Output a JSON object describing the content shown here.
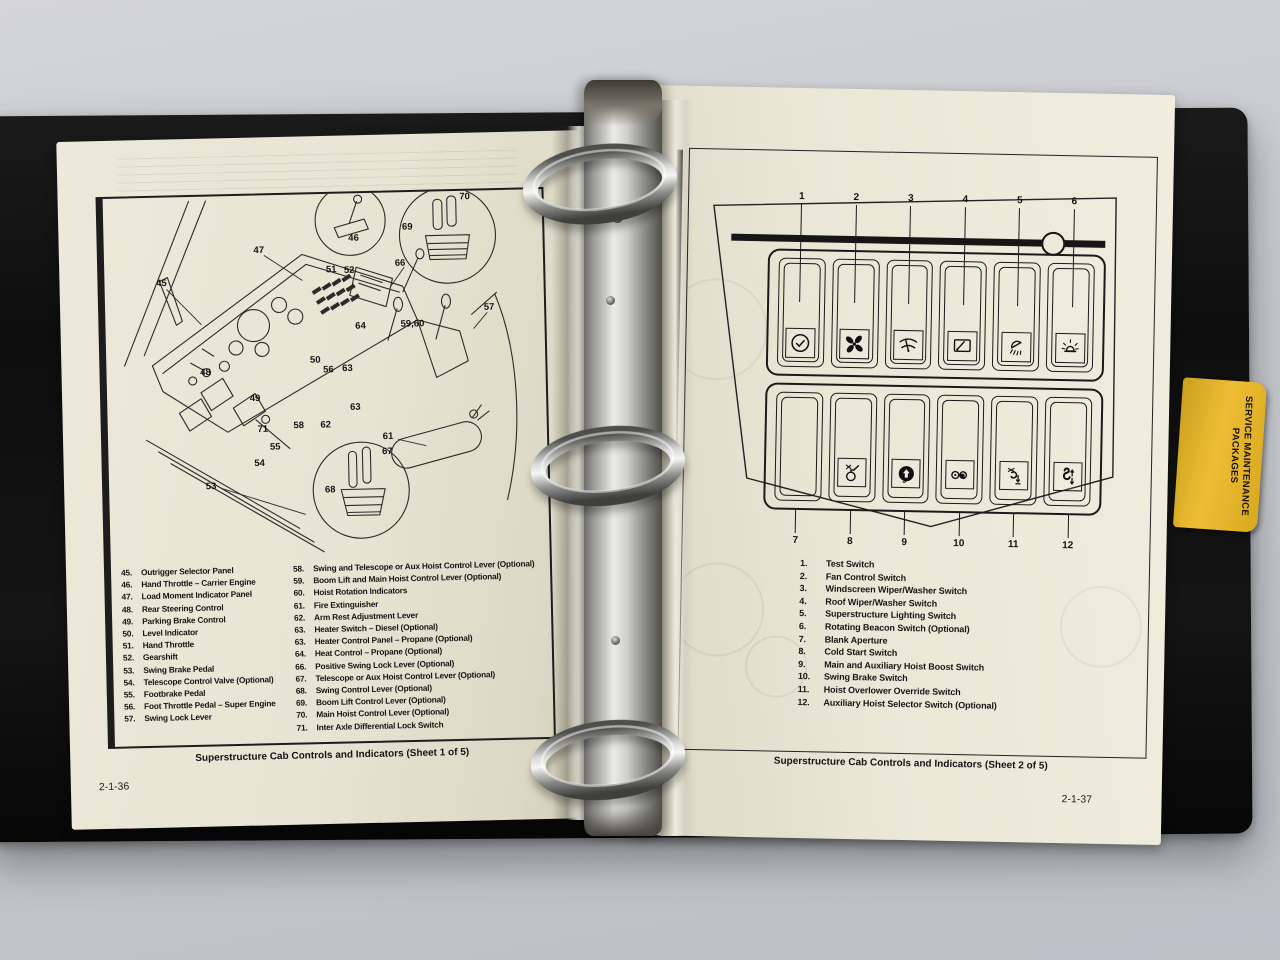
{
  "colors": {
    "desk": "#c9cbd0",
    "binder": "#121212",
    "page": "#e9e6d6",
    "tab_yellow": "#e3b02a",
    "ink": "#1a1a1a"
  },
  "binder": {
    "tab_label": "SERVICE MAINTENANCE PACKAGES"
  },
  "left_page": {
    "page_number": "2-1-36",
    "figure_caption": "Superstructure Cab Controls and Indicators (Sheet 1 of 5)",
    "callouts": [
      {
        "label": "45",
        "x": 57,
        "y": 86
      },
      {
        "label": "46",
        "x": 250,
        "y": 45
      },
      {
        "label": "47",
        "x": 155,
        "y": 55
      },
      {
        "label": "48",
        "x": 99,
        "y": 176
      },
      {
        "label": "49",
        "x": 148,
        "y": 203
      },
      {
        "label": "50",
        "x": 209,
        "y": 166
      },
      {
        "label": "51",
        "x": 227,
        "y": 76
      },
      {
        "label": "52",
        "x": 245,
        "y": 77
      },
      {
        "label": "53",
        "x": 102,
        "y": 290
      },
      {
        "label": "54",
        "x": 151,
        "y": 268
      },
      {
        "label": "55",
        "x": 167,
        "y": 252
      },
      {
        "label": "56",
        "x": 222,
        "y": 176
      },
      {
        "label": "57",
        "x": 384,
        "y": 117
      },
      {
        "label": "58",
        "x": 191,
        "y": 231
      },
      {
        "label": "59,60",
        "x": 307,
        "y": 132
      },
      {
        "label": "61",
        "x": 280,
        "y": 244
      },
      {
        "label": "62",
        "x": 218,
        "y": 231
      },
      {
        "label": "63",
        "x": 241,
        "y": 175
      },
      {
        "label": "63",
        "x": 248,
        "y": 214
      },
      {
        "label": "64",
        "x": 255,
        "y": 133
      },
      {
        "label": "66",
        "x": 296,
        "y": 71
      },
      {
        "label": "67",
        "x": 279,
        "y": 259
      },
      {
        "label": "68",
        "x": 221,
        "y": 296
      },
      {
        "label": "69",
        "x": 304,
        "y": 35
      },
      {
        "label": "70",
        "x": 362,
        "y": 6
      },
      {
        "label": "71",
        "x": 155,
        "y": 234
      }
    ],
    "legend_col1": [
      {
        "num": "45.",
        "label": "Outrigger Selector Panel"
      },
      {
        "num": "46.",
        "label": "Hand Throttle – Carrier Engine"
      },
      {
        "num": "47.",
        "label": "Load Moment Indicator Panel"
      },
      {
        "num": "48.",
        "label": "Rear Steering Control"
      },
      {
        "num": "49.",
        "label": "Parking Brake Control"
      },
      {
        "num": "50.",
        "label": "Level Indicator"
      },
      {
        "num": "51.",
        "label": "Hand Throttle"
      },
      {
        "num": "52.",
        "label": "Gearshift"
      },
      {
        "num": "53.",
        "label": "Swing Brake Pedal"
      },
      {
        "num": "54.",
        "label": "Telescope Control Valve (Optional)"
      },
      {
        "num": "55.",
        "label": "Footbrake Pedal"
      },
      {
        "num": "56.",
        "label": "Foot Throttle Pedal – Super Engine"
      },
      {
        "num": "57.",
        "label": "Swing Lock Lever"
      }
    ],
    "legend_col2": [
      {
        "num": "58.",
        "label": "Swing and Telescope or Aux Hoist Control Lever (Optional)"
      },
      {
        "num": "59.",
        "label": "Boom Lift and Main Hoist Control Lever (Optional)"
      },
      {
        "num": "60.",
        "label": "Hoist Rotation Indicators"
      },
      {
        "num": "61.",
        "label": "Fire Extinguisher"
      },
      {
        "num": "62.",
        "label": "Arm Rest Adjustment Lever"
      },
      {
        "num": "63.",
        "label": "Heater Switch – Diesel (Optional)"
      },
      {
        "num": "63.",
        "label": "Heater Control Panel – Propane (Optional)"
      },
      {
        "num": "64.",
        "label": "Heat Control – Propane (Optional)"
      },
      {
        "num": "66.",
        "label": "Positive Swing Lock Lever (Optional)"
      },
      {
        "num": "67.",
        "label": "Telescope or Aux Hoist Control Lever (Optional)"
      },
      {
        "num": "68.",
        "label": "Swing Control Lever (Optional)"
      },
      {
        "num": "69.",
        "label": "Boom Lift Control Lever (Optional)"
      },
      {
        "num": "70.",
        "label": "Main Hoist Control Lever (Optional)"
      },
      {
        "num": "71.",
        "label": "Inter Axle Differential Lock Switch"
      }
    ]
  },
  "right_page": {
    "page_number": "2-1-37",
    "figure_caption": "Superstructure Cab Controls and Indicators (Sheet 2 of 5)",
    "switches_top": [
      {
        "num": "1",
        "icon": "check-icon"
      },
      {
        "num": "2",
        "icon": "fan-icon"
      },
      {
        "num": "3",
        "icon": "wiper-screen-icon"
      },
      {
        "num": "4",
        "icon": "wiper-roof-icon"
      },
      {
        "num": "5",
        "icon": "light-icon"
      },
      {
        "num": "6",
        "icon": "beacon-icon"
      }
    ],
    "switches_bottom": [
      {
        "num": "7",
        "icon": "blank-icon"
      },
      {
        "num": "8",
        "icon": "cold-start-icon"
      },
      {
        "num": "9",
        "icon": "boost-icon"
      },
      {
        "num": "10",
        "icon": "swing-brake-icon"
      },
      {
        "num": "11",
        "icon": "hook-down-icon"
      },
      {
        "num": "12",
        "icon": "hook-updown-icon"
      }
    ],
    "legend": [
      {
        "num": "1.",
        "label": "Test Switch"
      },
      {
        "num": "2.",
        "label": "Fan Control Switch"
      },
      {
        "num": "3.",
        "label": "Windscreen Wiper/Washer Switch"
      },
      {
        "num": "4.",
        "label": "Roof Wiper/Washer Switch"
      },
      {
        "num": "5.",
        "label": "Superstructure Lighting Switch"
      },
      {
        "num": "6.",
        "label": "Rotating Beacon Switch (Optional)"
      },
      {
        "num": "7.",
        "label": "Blank Aperture"
      },
      {
        "num": "8.",
        "label": "Cold Start Switch"
      },
      {
        "num": "9.",
        "label": "Main and Auxiliary Hoist Boost Switch"
      },
      {
        "num": "10.",
        "label": "Swing Brake Switch"
      },
      {
        "num": "11.",
        "label": "Hoist Overlower Override Switch"
      },
      {
        "num": "12.",
        "label": "Auxiliary Hoist Selector Switch (Optional)"
      }
    ]
  }
}
